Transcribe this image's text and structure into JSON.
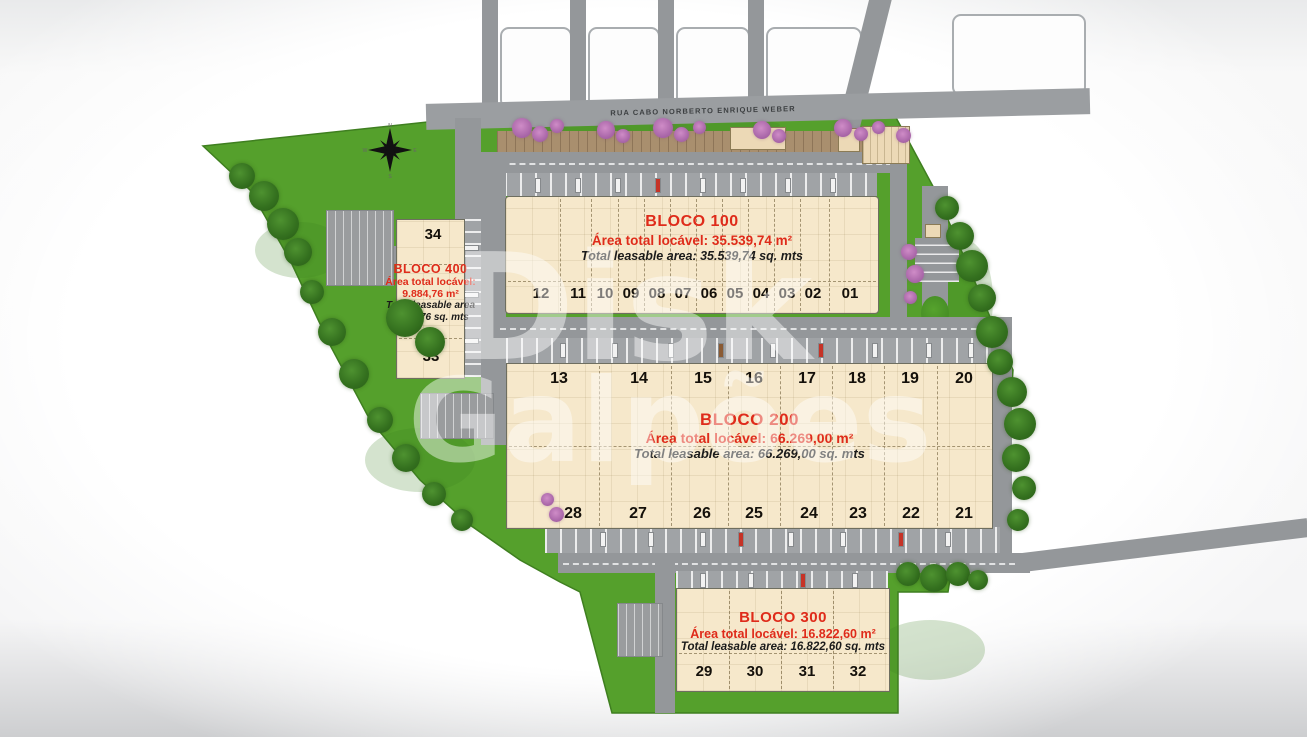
{
  "street": {
    "name": "RUA CABO NORBERTO ENRIQUE WEBER"
  },
  "watermark": {
    "line1": "Disk",
    "line2": "Galpões"
  },
  "compass": {
    "n": "N",
    "s": "S",
    "e": "E",
    "w": "W"
  },
  "colors": {
    "lawn": "#55a02c",
    "road": "#94979a",
    "building": "#f6e8cb",
    "accent_red": "#df2b1a",
    "watermark_white": "#ffffff"
  },
  "blocks": {
    "b100": {
      "title": "BLOCO 100",
      "area_pt": "Área total locável: 35.539,74 m²",
      "area_en": "Total leasable area: 35.539,74 sq. mts",
      "units": [
        "12",
        "11",
        "10",
        "09",
        "08",
        "07",
        "06",
        "05",
        "04",
        "03",
        "02",
        "01"
      ]
    },
    "b200": {
      "title": "BLOCO 200",
      "area_pt": "Área total locável: 66.269,00 m²",
      "area_en": "Total leasable area: 66.269,00 sq. mts",
      "units_top": [
        "13",
        "14",
        "15",
        "16",
        "17",
        "18",
        "19",
        "20"
      ],
      "units_bottom": [
        "28",
        "27",
        "26",
        "25",
        "24",
        "23",
        "22",
        "21"
      ]
    },
    "b300": {
      "title": "BLOCO 300",
      "area_pt": "Área total locável: 16.822,60 m²",
      "area_en": "Total leasable area: 16.822,60 sq. mts",
      "units": [
        "29",
        "30",
        "31",
        "32"
      ]
    },
    "b400": {
      "title": "BLOCO 400",
      "area_pt_line1": "Área total locável:",
      "area_pt_line2": "9.884,76 m²",
      "area_en_line1": "Total leasable area",
      "area_en_line2": "9.884,76 sq. mts",
      "units": [
        "34",
        "33"
      ]
    }
  }
}
